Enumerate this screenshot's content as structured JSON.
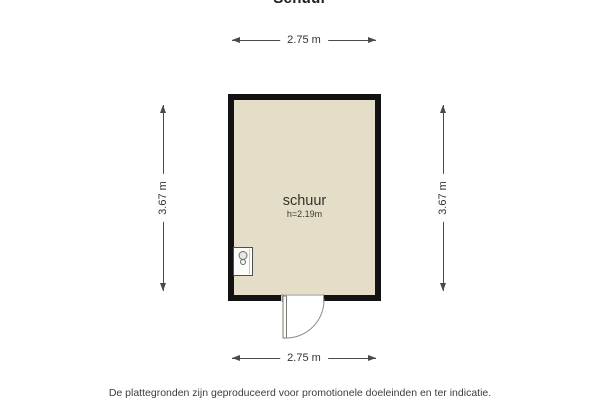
{
  "page": {
    "title": "Schuur",
    "footer": "De plattegronden zijn geproduceerd voor promotionele doeleinden en ter indicatie."
  },
  "floorplan": {
    "room": {
      "name": "schuur",
      "ceiling_height": "h=2.19m"
    },
    "dimensions": {
      "top": "2.75 m",
      "bottom": "2.75 m",
      "left": "3.67 m",
      "right": "3.67 m"
    },
    "fixtures": [
      {
        "icon": "boiler-icon",
        "position": "bottom-left-corner"
      }
    ],
    "door": {
      "wall": "bottom",
      "type": "single-swing-outward"
    },
    "colors": {
      "wall": "#121212",
      "floor": "#e4dec8",
      "dimension_line": "#4a4a4a",
      "door_line": "#8f8f89"
    }
  }
}
